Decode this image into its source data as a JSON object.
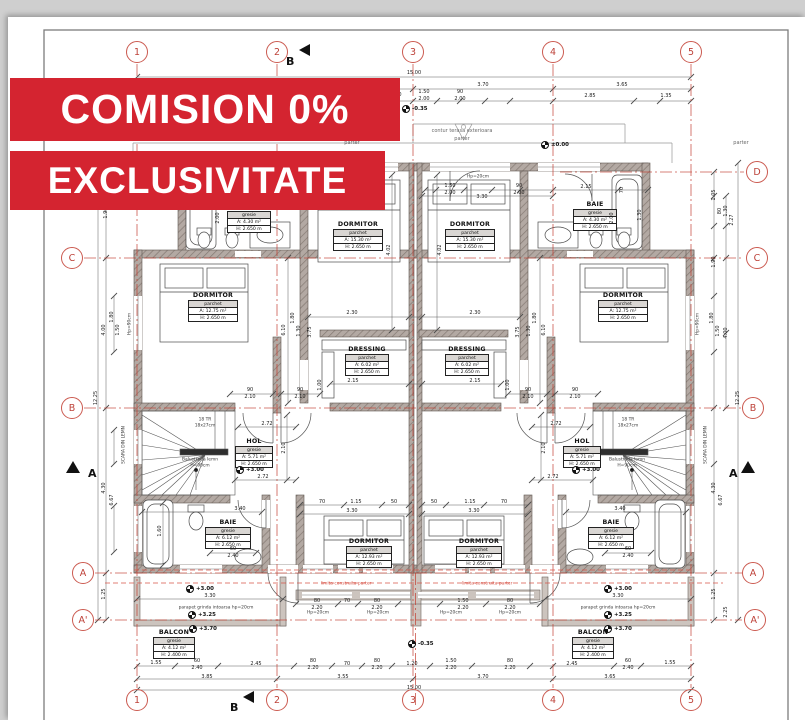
{
  "banners": {
    "line1": "COMISION 0%",
    "line2": "EXCLUSIVITATE"
  },
  "colors": {
    "banner_red": "#d42430",
    "axis_red": "#c23b2e",
    "limit_red": "#d8564a",
    "grid_bubble": "#bd4138"
  },
  "grid_bubbles": [
    {
      "t": "1",
      "x": 137,
      "y": 52
    },
    {
      "t": "2",
      "x": 277,
      "y": 52
    },
    {
      "t": "3",
      "x": 413,
      "y": 52
    },
    {
      "t": "4",
      "x": 553,
      "y": 52
    },
    {
      "t": "5",
      "x": 691,
      "y": 52
    },
    {
      "t": "1",
      "x": 137,
      "y": 700
    },
    {
      "t": "2",
      "x": 277,
      "y": 700
    },
    {
      "t": "3",
      "x": 413,
      "y": 700
    },
    {
      "t": "4",
      "x": 553,
      "y": 700
    },
    {
      "t": "5",
      "x": 691,
      "y": 700
    },
    {
      "t": "C",
      "x": 72,
      "y": 258
    },
    {
      "t": "B",
      "x": 72,
      "y": 408
    },
    {
      "t": "A",
      "x": 83,
      "y": 573
    },
    {
      "t": "A'",
      "x": 83,
      "y": 620
    },
    {
      "t": "D",
      "x": 757,
      "y": 172
    },
    {
      "t": "C",
      "x": 757,
      "y": 258
    },
    {
      "t": "B",
      "x": 753,
      "y": 408
    },
    {
      "t": "A",
      "x": 753,
      "y": 573
    },
    {
      "t": "A'",
      "x": 755,
      "y": 620
    }
  ],
  "section_markers": [
    {
      "t": "B",
      "tx": 299,
      "ty": 44,
      "lx": 286,
      "ly": 50,
      "rot": 1,
      "dir": "left"
    },
    {
      "t": "B",
      "tx": 243,
      "ty": 691,
      "lx": 230,
      "ly": 696,
      "rot": 1,
      "dir": "left"
    },
    {
      "t": "A",
      "tx": 66,
      "ty": 461,
      "lx": 88,
      "ly": 462,
      "rot": 0,
      "dir": "up"
    },
    {
      "t": "A",
      "tx": 741,
      "ty": 461,
      "lx": 729,
      "ly": 462,
      "rot": 0,
      "dir": "up"
    }
  ],
  "rooms": [
    {
      "name": "BAIE",
      "floor": "gresie",
      "area": "A:  4.30 m²",
      "height": "H: 2.650 m",
      "x": 227,
      "y": 212,
      "w": 44
    },
    {
      "name": "DORMITOR",
      "floor": "parchet",
      "area": "A:  15.30 m²",
      "height": "H: 2.650 m",
      "x": 333,
      "y": 230,
      "w": 50
    },
    {
      "name": "DORMITOR",
      "floor": "parchet",
      "area": "A:  12.75 m²",
      "height": "H: 2.650 m",
      "x": 188,
      "y": 301,
      "w": 50
    },
    {
      "name": "DRESSING",
      "floor": "parchet",
      "area": "A:  6.02 m²",
      "height": "H: 2.650 m",
      "x": 345,
      "y": 355,
      "w": 44
    },
    {
      "name": "HOL",
      "floor": "gresie",
      "area": "A:  5.71 m²",
      "height": "H: 2.650 m",
      "x": 235,
      "y": 447,
      "w": 38
    },
    {
      "name": "BAIE",
      "floor": "gresie",
      "area": "A:  6.12 m²",
      "height": "H: 2.650 m",
      "x": 205,
      "y": 528,
      "w": 46
    },
    {
      "name": "DORMITOR",
      "floor": "parchet",
      "area": "A:  12.93 m²",
      "height": "H: 2.650 m",
      "x": 346,
      "y": 547,
      "w": 46
    },
    {
      "name": "BALCON",
      "floor": "gresie",
      "area": "A:  4.12 m²",
      "height": "H: 2.400 m",
      "x": 153,
      "y": 638,
      "w": 42
    },
    {
      "name": "BAIE",
      "floor": "gresie",
      "area": "A:  4.30 m²",
      "height": "H: 2.650 m",
      "x": 573,
      "y": 210,
      "w": 44
    },
    {
      "name": "DORMITOR",
      "floor": "parchet",
      "area": "A:  15.30 m²",
      "height": "H: 2.650 m",
      "x": 445,
      "y": 230,
      "w": 50
    },
    {
      "name": "DORMITOR",
      "floor": "parchet",
      "area": "A:  12.75 m²",
      "height": "H: 2.650 m",
      "x": 598,
      "y": 301,
      "w": 50
    },
    {
      "name": "DRESSING",
      "floor": "parchet",
      "area": "A:  6.02 m²",
      "height": "H: 2.650 m",
      "x": 445,
      "y": 355,
      "w": 44
    },
    {
      "name": "HOL",
      "floor": "gresie",
      "area": "A:  5.71 m²",
      "height": "H: 2.650 m",
      "x": 563,
      "y": 447,
      "w": 38
    },
    {
      "name": "BAIE",
      "floor": "gresie",
      "area": "A:  6.12 m²",
      "height": "H: 2.650 m",
      "x": 588,
      "y": 528,
      "w": 46
    },
    {
      "name": "DORMITOR",
      "floor": "parchet",
      "area": "A:  12.93 m²",
      "height": "H: 2.650 m",
      "x": 456,
      "y": 547,
      "w": 46
    },
    {
      "name": "BALCON",
      "floor": "gresie",
      "area": "A:  4.12 m²",
      "height": "H: 2.400 m",
      "x": 572,
      "y": 638,
      "w": 42
    }
  ],
  "levels": [
    {
      "t": "±0.00",
      "x": 545,
      "y": 145
    },
    {
      "t": "-0.35",
      "x": 406,
      "y": 109
    },
    {
      "t": "-0.35",
      "x": 412,
      "y": 644
    },
    {
      "t": "+3.00",
      "x": 240,
      "y": 470
    },
    {
      "t": "+3.00",
      "x": 576,
      "y": 470
    },
    {
      "t": "+3.00",
      "x": 190,
      "y": 589
    },
    {
      "t": "+3.00",
      "x": 608,
      "y": 589
    },
    {
      "t": "+3.25",
      "x": 192,
      "y": 615
    },
    {
      "t": "+3.25",
      "x": 608,
      "y": 615
    },
    {
      "t": "+3.70",
      "x": 193,
      "y": 629
    },
    {
      "t": "+3.70",
      "x": 608,
      "y": 629
    }
  ],
  "annotations": [
    {
      "t": "contur terasa exterioara",
      "x": 462,
      "y": 131,
      "cls": "gray"
    },
    {
      "t": "parter",
      "x": 462,
      "y": 139,
      "cls": "gray"
    },
    {
      "t": "parter",
      "x": 352,
      "y": 143,
      "cls": "gray"
    },
    {
      "t": "parter",
      "x": 741,
      "y": 143,
      "cls": "gray"
    },
    {
      "t": "limita construita parter",
      "x": 346,
      "y": 584,
      "cls": "red"
    },
    {
      "t": "limita construita parter",
      "x": 487,
      "y": 584,
      "cls": "red"
    },
    {
      "t": "parapet grinda intoarsa hp=20cm",
      "x": 216,
      "y": 608
    },
    {
      "t": "parapet grinda intoarsa hp=20cm",
      "x": 618,
      "y": 608
    },
    {
      "t": "Balustrada lemn",
      "x": 200,
      "y": 460
    },
    {
      "t": "H=90cm",
      "x": 200,
      "y": 466
    },
    {
      "t": "Balustrada lemn",
      "x": 627,
      "y": 460
    },
    {
      "t": "H=90cm",
      "x": 627,
      "y": 466
    },
    {
      "t": "SCARA DIN LEMN",
      "x": 124,
      "y": 445,
      "rot": 1
    },
    {
      "t": "SCARA DIN LEMN",
      "x": 706,
      "y": 445,
      "rot": 1
    },
    {
      "t": "18 TR",
      "x": 205,
      "y": 420
    },
    {
      "t": "18x27cm",
      "x": 205,
      "y": 426
    },
    {
      "t": "18 TR",
      "x": 628,
      "y": 420
    },
    {
      "t": "18x27cm",
      "x": 628,
      "y": 426
    },
    {
      "t": "Hp=20cm",
      "x": 478,
      "y": 177
    },
    {
      "t": "Hp=20cm",
      "x": 318,
      "y": 613
    },
    {
      "t": "Hp=20cm",
      "x": 378,
      "y": 613
    },
    {
      "t": "Hp=20cm",
      "x": 451,
      "y": 613
    },
    {
      "t": "Hp=20cm",
      "x": 510,
      "y": 613
    },
    {
      "t": "Hp=90cm",
      "x": 130,
      "y": 324,
      "rot": 1
    },
    {
      "t": "Hp=90cm",
      "x": 698,
      "y": 324,
      "rot": 1
    }
  ],
  "dims": [
    {
      "t": "15.00",
      "x": 414,
      "y": 73
    },
    {
      "t": "3.70",
      "x": 483,
      "y": 85
    },
    {
      "t": "3.65",
      "x": 622,
      "y": 85
    },
    {
      "t": "1.80",
      "x": 396,
      "y": 95
    },
    {
      "t": "1.50",
      "x": 424,
      "y": 92
    },
    {
      "t": "2.00",
      "x": 424,
      "y": 99
    },
    {
      "t": "90",
      "x": 460,
      "y": 92
    },
    {
      "t": "2.00",
      "x": 460,
      "y": 99
    },
    {
      "t": "2.85",
      "x": 590,
      "y": 96
    },
    {
      "t": "1.35",
      "x": 666,
      "y": 96
    },
    {
      "t": "3.30",
      "x": 482,
      "y": 197
    },
    {
      "t": "2.15",
      "x": 586,
      "y": 187
    },
    {
      "t": "1.50",
      "x": 450,
      "y": 186
    },
    {
      "t": "2.00",
      "x": 450,
      "y": 193
    },
    {
      "t": "90",
      "x": 519,
      "y": 186
    },
    {
      "t": "2.00",
      "x": 519,
      "y": 193
    },
    {
      "t": "70",
      "x": 622,
      "y": 190,
      "r": 1
    },
    {
      "t": "2.00",
      "x": 612,
      "y": 218,
      "r": 1
    },
    {
      "t": "1.30",
      "x": 640,
      "y": 215,
      "r": 1
    },
    {
      "t": "2.00",
      "x": 218,
      "y": 218,
      "r": 1
    },
    {
      "t": "2.30",
      "x": 352,
      "y": 313
    },
    {
      "t": "2.30",
      "x": 475,
      "y": 313
    },
    {
      "t": "2.15",
      "x": 353,
      "y": 381
    },
    {
      "t": "2.15",
      "x": 475,
      "y": 381
    },
    {
      "t": "6.10",
      "x": 284,
      "y": 330,
      "r": 1
    },
    {
      "t": "6.10",
      "x": 544,
      "y": 330,
      "r": 1
    },
    {
      "t": "4.02",
      "x": 389,
      "y": 250,
      "r": 1
    },
    {
      "t": "4.02",
      "x": 440,
      "y": 250,
      "r": 1
    },
    {
      "t": "3.75",
      "x": 310,
      "y": 332,
      "r": 1
    },
    {
      "t": "3.75",
      "x": 518,
      "y": 332,
      "r": 1
    },
    {
      "t": "1.80",
      "x": 293,
      "y": 318,
      "r": 1
    },
    {
      "t": "1.30",
      "x": 299,
      "y": 331,
      "r": 1
    },
    {
      "t": "1.80",
      "x": 535,
      "y": 318,
      "r": 1
    },
    {
      "t": "1.30",
      "x": 529,
      "y": 331,
      "r": 1
    },
    {
      "t": "90",
      "x": 250,
      "y": 390
    },
    {
      "t": "2.10",
      "x": 250,
      "y": 397
    },
    {
      "t": "90",
      "x": 300,
      "y": 390
    },
    {
      "t": "2.10",
      "x": 300,
      "y": 397
    },
    {
      "t": "90",
      "x": 528,
      "y": 390
    },
    {
      "t": "2.10",
      "x": 528,
      "y": 397
    },
    {
      "t": "90",
      "x": 575,
      "y": 390
    },
    {
      "t": "2.10",
      "x": 575,
      "y": 397
    },
    {
      "t": "1.00",
      "x": 320,
      "y": 385,
      "r": 1
    },
    {
      "t": "1.00",
      "x": 508,
      "y": 385,
      "r": 1
    },
    {
      "t": "2.72",
      "x": 267,
      "y": 424
    },
    {
      "t": "2.72",
      "x": 263,
      "y": 477
    },
    {
      "t": "2.72",
      "x": 556,
      "y": 424
    },
    {
      "t": "2.72",
      "x": 553,
      "y": 477
    },
    {
      "t": "2.10",
      "x": 284,
      "y": 448,
      "r": 1
    },
    {
      "t": "2.10",
      "x": 544,
      "y": 448,
      "r": 1
    },
    {
      "t": "3.40",
      "x": 240,
      "y": 509
    },
    {
      "t": "3.40",
      "x": 620,
      "y": 509
    },
    {
      "t": "60",
      "x": 233,
      "y": 549
    },
    {
      "t": "2.40",
      "x": 233,
      "y": 556
    },
    {
      "t": "60",
      "x": 628,
      "y": 549
    },
    {
      "t": "2.40",
      "x": 628,
      "y": 556
    },
    {
      "t": "1.60",
      "x": 160,
      "y": 531,
      "r": 1
    },
    {
      "t": "70",
      "x": 322,
      "y": 502
    },
    {
      "t": "1.15",
      "x": 356,
      "y": 502
    },
    {
      "t": "50",
      "x": 394,
      "y": 502
    },
    {
      "t": "3.30",
      "x": 352,
      "y": 511
    },
    {
      "t": "50",
      "x": 434,
      "y": 502
    },
    {
      "t": "1.15",
      "x": 470,
      "y": 502
    },
    {
      "t": "70",
      "x": 504,
      "y": 502
    },
    {
      "t": "3.30",
      "x": 474,
      "y": 511
    },
    {
      "t": "80",
      "x": 317,
      "y": 601
    },
    {
      "t": "2.20",
      "x": 317,
      "y": 608
    },
    {
      "t": "70",
      "x": 347,
      "y": 601
    },
    {
      "t": "80",
      "x": 377,
      "y": 601
    },
    {
      "t": "2.20",
      "x": 377,
      "y": 608
    },
    {
      "t": "1.50",
      "x": 463,
      "y": 601
    },
    {
      "t": "2.20",
      "x": 463,
      "y": 608
    },
    {
      "t": "80",
      "x": 510,
      "y": 601
    },
    {
      "t": "2.20",
      "x": 510,
      "y": 608
    },
    {
      "t": "3.30",
      "x": 210,
      "y": 596
    },
    {
      "t": "3.30",
      "x": 618,
      "y": 596
    },
    {
      "t": "1.55",
      "x": 156,
      "y": 663
    },
    {
      "t": "60",
      "x": 197,
      "y": 661
    },
    {
      "t": "2.40",
      "x": 197,
      "y": 668
    },
    {
      "t": "2.45",
      "x": 256,
      "y": 664
    },
    {
      "t": "80",
      "x": 313,
      "y": 661
    },
    {
      "t": "2.20",
      "x": 313,
      "y": 668
    },
    {
      "t": "70",
      "x": 347,
      "y": 664
    },
    {
      "t": "80",
      "x": 377,
      "y": 661
    },
    {
      "t": "2.20",
      "x": 377,
      "y": 668
    },
    {
      "t": "1.20",
      "x": 412,
      "y": 664
    },
    {
      "t": "1.50",
      "x": 451,
      "y": 661
    },
    {
      "t": "2.20",
      "x": 451,
      "y": 668
    },
    {
      "t": "80",
      "x": 510,
      "y": 661
    },
    {
      "t": "2.20",
      "x": 510,
      "y": 668
    },
    {
      "t": "2.45",
      "x": 572,
      "y": 664
    },
    {
      "t": "60",
      "x": 628,
      "y": 661
    },
    {
      "t": "2.40",
      "x": 628,
      "y": 668
    },
    {
      "t": "1.55",
      "x": 670,
      "y": 663
    },
    {
      "t": "3.85",
      "x": 207,
      "y": 677
    },
    {
      "t": "3.55",
      "x": 343,
      "y": 677
    },
    {
      "t": "3.70",
      "x": 483,
      "y": 677
    },
    {
      "t": "3.65",
      "x": 610,
      "y": 677
    },
    {
      "t": "15.00",
      "x": 414,
      "y": 688
    },
    {
      "t": "1.90",
      "x": 106,
      "y": 213,
      "r": 1
    },
    {
      "t": "4.00",
      "x": 104,
      "y": 330,
      "r": 1
    },
    {
      "t": "1.80",
      "x": 112,
      "y": 317,
      "r": 1
    },
    {
      "t": "1.50",
      "x": 118,
      "y": 330,
      "r": 1
    },
    {
      "t": "12.25",
      "x": 96,
      "y": 398,
      "r": 1
    },
    {
      "t": "4.30",
      "x": 104,
      "y": 488,
      "r": 1
    },
    {
      "t": "6.67",
      "x": 112,
      "y": 500,
      "r": 1
    },
    {
      "t": "1.25",
      "x": 104,
      "y": 594,
      "r": 1
    },
    {
      "t": "1.05",
      "x": 714,
      "y": 195,
      "r": 1
    },
    {
      "t": "80",
      "x": 720,
      "y": 211,
      "r": 1
    },
    {
      "t": "1.30",
      "x": 726,
      "y": 211,
      "r": 1
    },
    {
      "t": "2.27",
      "x": 732,
      "y": 220,
      "r": 1
    },
    {
      "t": "1.90",
      "x": 714,
      "y": 262,
      "r": 1
    },
    {
      "t": "1.80",
      "x": 712,
      "y": 318,
      "r": 1
    },
    {
      "t": "1.50",
      "x": 718,
      "y": 331,
      "r": 1
    },
    {
      "t": "4.00",
      "x": 726,
      "y": 333,
      "r": 1
    },
    {
      "t": "12.25",
      "x": 738,
      "y": 398,
      "r": 1
    },
    {
      "t": "4.30",
      "x": 714,
      "y": 488,
      "r": 1
    },
    {
      "t": "6.67",
      "x": 721,
      "y": 500,
      "r": 1
    },
    {
      "t": "1.25",
      "x": 714,
      "y": 594,
      "r": 1
    },
    {
      "t": "2.25",
      "x": 726,
      "y": 612,
      "r": 1
    }
  ]
}
